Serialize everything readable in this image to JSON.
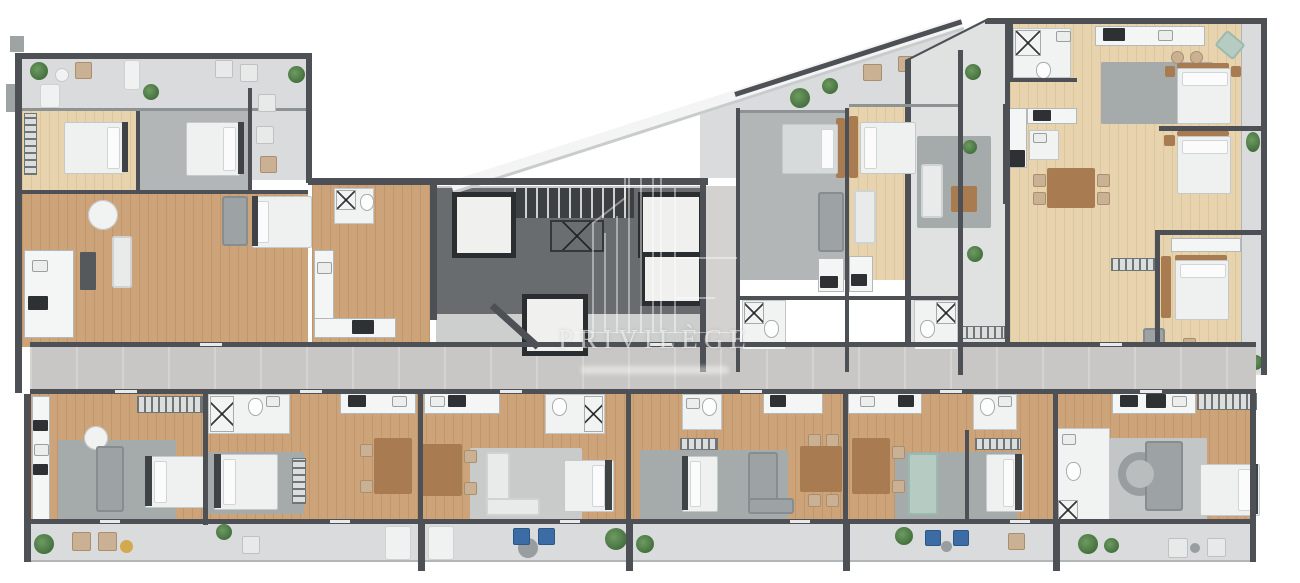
{
  "watermark": {
    "title": "PRIVILÈGE"
  },
  "palette": {
    "wall": "#4d5156",
    "core_slab": "#686c6f",
    "wood": "#cda47a",
    "wood_light": "#e7d3ad",
    "gray_floor": "#b2b6b7",
    "rug": "#a5aaab",
    "balcony": "#d9dbdc",
    "corridor": "#c8c7c5",
    "white_fixture": "#f1f2f2",
    "furniture_gray": "#9da2a4",
    "furniture_white": "#e9eaea",
    "teal_sofa": "#b6ccc2",
    "blue_chair": "#3b6ca5",
    "plant": "#44703f",
    "wood_furniture": "#a87c50",
    "yellow_pouf": "#d3a94f",
    "watermark_text": "rgba(248,248,248,0.6)"
  },
  "structure": {
    "elevators": 4,
    "stairwells": 1,
    "plan_type": "residential-floor-plan"
  }
}
